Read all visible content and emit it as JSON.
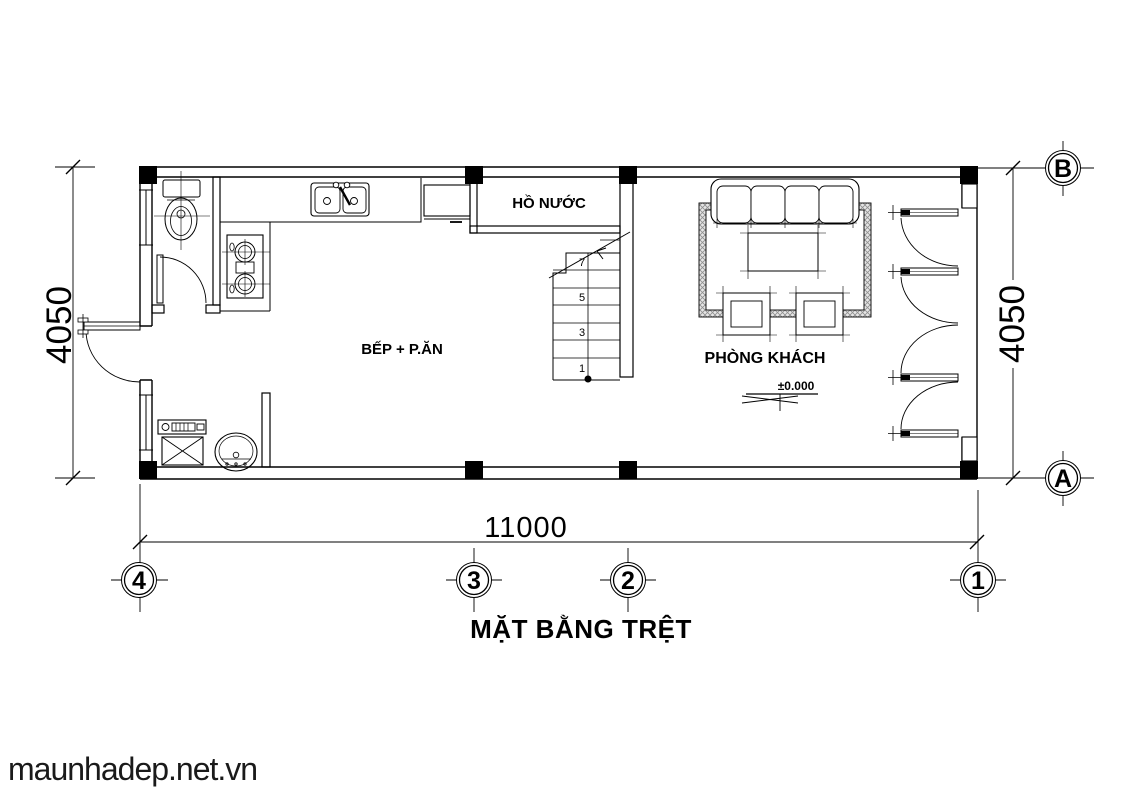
{
  "plan": {
    "title": "MẶT BẰNG TRỆT",
    "watermark": "maunhadep.net.vn",
    "rooms": {
      "kitchen_dining": "BẾP + P.ĂN",
      "living_room": "PHÒNG KHÁCH",
      "water_tank": "HỒ NƯỚC"
    },
    "level_marker": "±0.000",
    "dimensions": {
      "width_bottom": "11000",
      "height_left": "4050",
      "height_right": "4050"
    },
    "grid": {
      "columns": [
        "4",
        "3",
        "2",
        "1"
      ],
      "rows": [
        "B",
        "A"
      ]
    },
    "stairs": {
      "visible_step_numbers": [
        "7",
        "5",
        "3",
        "1"
      ]
    },
    "colors": {
      "line": "#000000",
      "background": "#ffffff",
      "rug_hatch": "#8f8f8f"
    }
  }
}
